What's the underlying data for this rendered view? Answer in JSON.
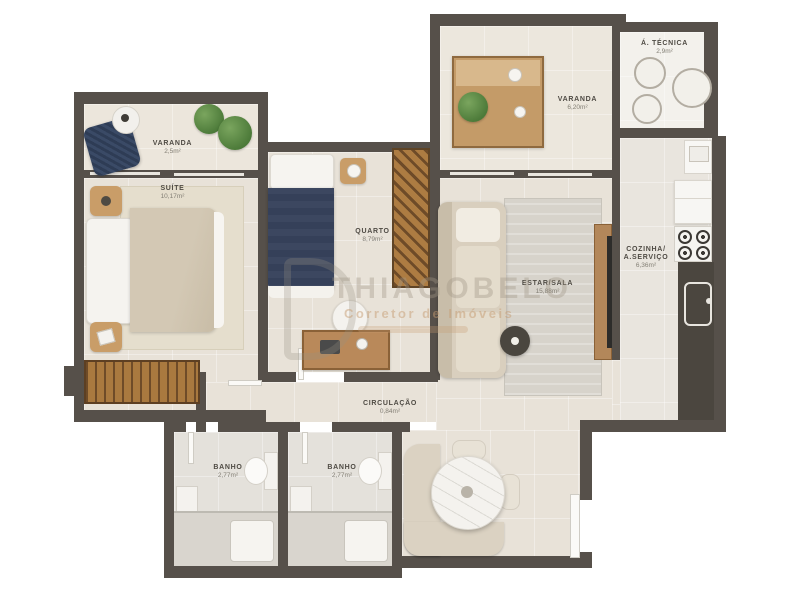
{
  "rooms": {
    "varanda_left": {
      "name": "VARANDA",
      "area": "2,5m²"
    },
    "suite": {
      "name": "SUÍTE",
      "area": "10,17m²"
    },
    "quarto": {
      "name": "QUARTO",
      "area": "8,79m²"
    },
    "varanda_top": {
      "name": "VARANDA",
      "area": "6,20m²"
    },
    "tecnica": {
      "name": "Á. TÉCNICA",
      "area": "2,9m²"
    },
    "estar": {
      "name": "ESTAR/SALA",
      "area": "15,88m²"
    },
    "cozinha": {
      "name1": "COZINHA/",
      "name2": "A.SERVIÇO",
      "area": "6,36m²"
    },
    "circulacao": {
      "name": "CIRCULAÇÃO",
      "area": "0,84m²"
    },
    "banho1": {
      "name": "BANHO",
      "area": "2,77m²"
    },
    "banho2": {
      "name": "BANHO",
      "area": "2,77m²"
    }
  },
  "watermark": {
    "brand": "THIAGOBELO",
    "tagline": "Corretor de Imóveis"
  },
  "colors": {
    "wall": "#56504a",
    "floor": "#e8e2d8",
    "wood": "#b98a5a",
    "navy_bed": "#3c4760",
    "plant_green": "#5a8a44",
    "label_text": "#4f4b44"
  }
}
